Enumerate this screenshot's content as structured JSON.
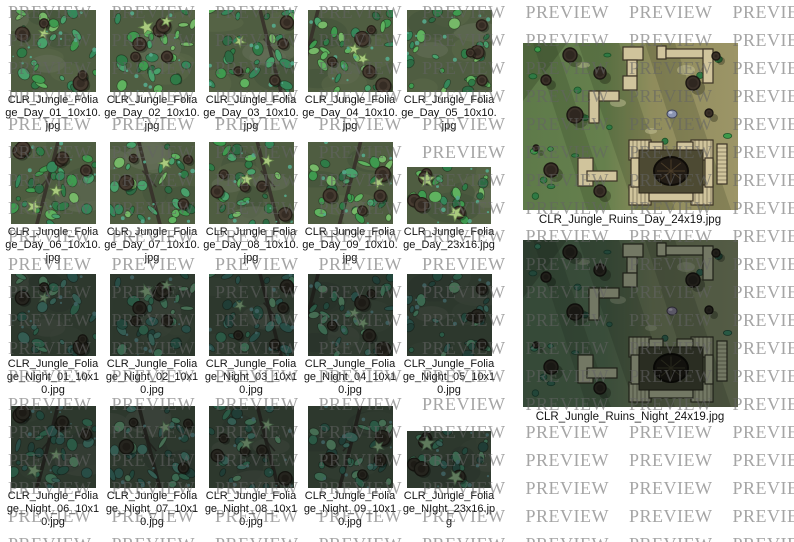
{
  "watermark": {
    "text": "PREVIEW",
    "color": "#a0a0a0"
  },
  "thumbnails": [
    {
      "filename": "CLR_Jungle_Foliage_Day_01_10x10.jpg",
      "variant": "day",
      "wide": false
    },
    {
      "filename": "CLR_Jungle_Foliage_Day_02_10x10.jpg",
      "variant": "day",
      "wide": false
    },
    {
      "filename": "CLR_Jungle_Foliage_Day_03_10x10.jpg",
      "variant": "day",
      "wide": false
    },
    {
      "filename": "CLR_Jungle_Foliage_Day_04_10x10.jpg",
      "variant": "day",
      "wide": false
    },
    {
      "filename": "CLR_Jungle_Foliage_Day_05_10x10.jpg",
      "variant": "day",
      "wide": false
    },
    {
      "filename": "CLR_Jungle_Foliage_Day_06_10x10.jpg",
      "variant": "day",
      "wide": false
    },
    {
      "filename": "CLR_Jungle_Foliage_Day_07_10x10.jpg",
      "variant": "day",
      "wide": false
    },
    {
      "filename": "CLR_Jungle_Foliage_Day_08_10x10.jpg",
      "variant": "day",
      "wide": false
    },
    {
      "filename": "CLR_Jungle_Foliage_Day_09_10x10.jpg",
      "variant": "day",
      "wide": false
    },
    {
      "filename": "CLR_Jungle_Foliage_Day_23x16.jpg",
      "variant": "day",
      "wide": true
    },
    {
      "filename": "CLR_Jungle_Foliage_Night_01_10x10.jpg",
      "variant": "night",
      "wide": false
    },
    {
      "filename": "CLR_Jungle_Foliage_Night_02_10x10.jpg",
      "variant": "night",
      "wide": false
    },
    {
      "filename": "CLR_Jungle_Foliage_Night_03_10x10.jpg",
      "variant": "night",
      "wide": false
    },
    {
      "filename": "CLR_Jungle_Foliage_Night_04_10x10.jpg",
      "variant": "night",
      "wide": false
    },
    {
      "filename": "CLR_Jungle_Foliage_Night_05_10x10.jpg",
      "variant": "night",
      "wide": false
    },
    {
      "filename": "CLR_Jungle_Foliage_Night_06_10x10.jpg",
      "variant": "night",
      "wide": false
    },
    {
      "filename": "CLR_Jungle_Foliage_Night_07_10x10.jpg",
      "variant": "night",
      "wide": false
    },
    {
      "filename": "CLR_Jungle_Foliage_Night_08_10x10.jpg",
      "variant": "night",
      "wide": false
    },
    {
      "filename": "CLR_Jungle_Foliage_Night_09_10x10.jpg",
      "variant": "night",
      "wide": false
    },
    {
      "filename": "CLR_Jungle_Foliage_NIght_23x16.jpg",
      "variant": "night",
      "wide": true
    }
  ],
  "large_previews": [
    {
      "filename": "CLR_Jungle_Ruins_Day_24x19.jpg",
      "variant": "day"
    },
    {
      "filename": "CLR_Jungle_Ruins_Night_24x19.jpg",
      "variant": "night"
    }
  ],
  "palette": {
    "foliage_base": "#4f5d41",
    "foliage_patches": [
      "#44523a",
      "#5b6849",
      "#66705a"
    ],
    "foliage_greens": [
      "#3f9a4f",
      "#2f7b47",
      "#5fb25f",
      "#35875a",
      "#49a06b",
      "#2d6b44",
      "#76b868"
    ],
    "foliage_teal": "#55aa8c",
    "tree_fill": "#453a30",
    "tree_stroke": "#262018",
    "tree_inner": "#352c24",
    "star_leaf": "#aaca7e",
    "star_stroke": "#64824a",
    "vine": "#36312a",
    "ruins_green": "#5e7a4a",
    "ruins_olive": "#9c9567",
    "wall_tan": "#d0c49c",
    "wall_stroke": "#3b3326",
    "caption_color": "#141414"
  }
}
